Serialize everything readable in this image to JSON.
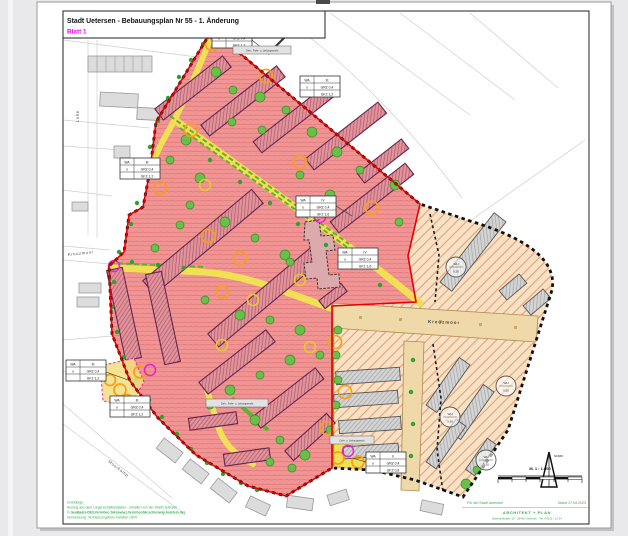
{
  "title_block": {
    "title": "Stadt Uetersen - Bebauungsplan Nr 55 - 1. Änderung",
    "sheet": "Blatt 1"
  },
  "streets": {
    "lohe": "Lohe",
    "kreuzmoor_left": "Kreuzmoor",
    "kreuzmoor_road": "Kreuzmoor",
    "bottom_left": "Moorkamp"
  },
  "zoning_tables": [
    {
      "use": "WA",
      "storeys": "III",
      "open": "o",
      "grz": "GRZ 0,4",
      "gfz": "GFZ 1,2"
    },
    {
      "use": "WA",
      "storeys": "III",
      "open": "o",
      "grz": "GRZ 0,4",
      "gfz": "GFZ 1,2"
    },
    {
      "use": "WA",
      "storeys": "III",
      "open": "o",
      "grz": "GRZ 0,4",
      "gfz": "GFZ 1,2"
    },
    {
      "use": "WA",
      "storeys": "IV",
      "open": "o",
      "grz": "GRZ 0,4",
      "gfz": "GFZ 1,6"
    },
    {
      "use": "WA",
      "storeys": "IV",
      "open": "o",
      "grz": "GRZ 0,4",
      "gfz": "GFZ 1,6"
    },
    {
      "use": "WA",
      "storeys": "III",
      "open": "o",
      "grz": "GRZ 0,4",
      "gfz": "GFZ 1,2"
    },
    {
      "use": "WA",
      "storeys": "III",
      "open": "o",
      "grz": "GRZ 0,4",
      "gfz": "GFZ 1,2"
    },
    {
      "use": "WA",
      "storeys": "II",
      "open": "o",
      "grz": "GRZ 0,4",
      "gfz": "GFZ 0,8"
    }
  ],
  "height_circles": [
    {
      "top": "WH",
      "bottom": "9,50"
    },
    {
      "top": "WH",
      "bottom": "9,50"
    },
    {
      "top": "WH",
      "bottom": "9,50"
    },
    {
      "top": "WH",
      "bottom": "9,50"
    }
  ],
  "annotations": [
    {
      "text": "Geh-, Fahr- u. Leitungsrecht"
    },
    {
      "text": "Geh- u. Leitungsrecht"
    },
    {
      "text": "Geh-, Fahr- u. Leitungsrecht"
    }
  ],
  "compass": {
    "north_label": "NORD"
  },
  "scale_bar": {
    "label": "M. 1 : 1.000"
  },
  "credits": {
    "heading": "Grundlage:",
    "line1": "Auszug aus dem Liegenschaftskataster - erhalten von der Stadt Uetersen",
    "line2": "© GeoBasis-DE/LVermGeo SH (www.LVermGeoSH.schleswig-holstein.de)",
    "line3": "Vermessung: Vermessungsbüro Fahsten ÖbVI",
    "for_city": "Für die Stadt Uetersen",
    "date": "Stand 17.04.2023",
    "firm_name": "ARCHITEKT + PLAN",
    "firm_address": "Bahnhofstraße 10 · 25436 Uetersen · Tel. 04122 / 12 34"
  },
  "colors": {
    "residential_pink": "#f09494",
    "existing_tan": "#f8e2c6",
    "road_yellow": "#f2e054",
    "boundary_red": "#e80000",
    "scope_boundary_black": "#111111",
    "tree_green": "#4caf32",
    "ring_orange": "#f5a11c",
    "ring_magenta": "#ea1fd0",
    "credit_green": "#2fae4e",
    "sheet_magenta": "#ee00ee"
  }
}
